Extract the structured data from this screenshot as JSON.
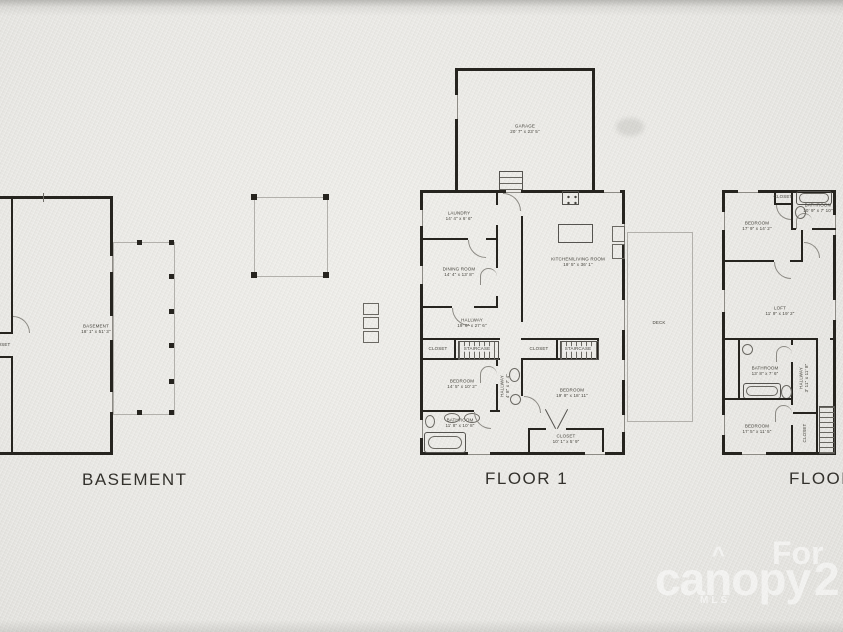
{
  "plans": {
    "basement": {
      "title": "BASEMENT",
      "rooms": {
        "basement": {
          "name": "BASEMENT",
          "dims": "18' 1\" x 51' 3\""
        },
        "closet": {
          "name": "CLOSET"
        }
      }
    },
    "floor1": {
      "title": "FLOOR 1",
      "rooms": {
        "garage": {
          "name": "GARAGE",
          "dims": "20' 7\" x 23' 5\""
        },
        "laundry": {
          "name": "LAUNDRY",
          "dims": "14' 4\" x 6' 6\""
        },
        "dining": {
          "name": "DINING ROOM",
          "dims": "14' 4\" x 13' 8\""
        },
        "kitchen_living": {
          "name": "KITCHEN/LIVING ROOM",
          "dims": "19' 5\" x 36' 1\""
        },
        "hallway": {
          "name": "HALLWAY",
          "dims": "19' 6\" x 27' 6\""
        },
        "closet_left": {
          "name": "CLOSET"
        },
        "stair_left": {
          "name": "STAIRCASE"
        },
        "closet_right": {
          "name": "CLOSET"
        },
        "stair_right": {
          "name": "STAIRCASE"
        },
        "bedroom_left": {
          "name": "BEDROOM",
          "dims": "14' 5\" x 10' 2\""
        },
        "hall_small": {
          "name": "HALLWAY",
          "dims": "4' 8\" x 7' 4\""
        },
        "bedroom_right": {
          "name": "BEDROOM",
          "dims": "19' 9\" x 18' 11\""
        },
        "bathroom": {
          "name": "BATHROOM",
          "dims": "11' 8\" x 10' 8\""
        },
        "closet_bottom": {
          "name": "CLOSET",
          "dims": "10' 1\" x 5' 9\""
        },
        "deck": {
          "name": "DECK"
        }
      }
    },
    "floor2": {
      "title": "FLOOR 2",
      "rooms": {
        "bedroom_top": {
          "name": "BEDROOM",
          "dims": "17' 9\" x 14' 2\""
        },
        "closet_top": {
          "name": "CLOSET"
        },
        "bathroom_top": {
          "name": "BATHROOM",
          "dims": "10' 9\" x 7' 10\""
        },
        "loft": {
          "name": "LOFT",
          "dims": "11' 9\" x 19' 2\""
        },
        "bathroom_mid": {
          "name": "BATHROOM",
          "dims": "13' 8\" x 7' 6\""
        },
        "hallway": {
          "name": "HALLWAY",
          "dims": "3' 11\" x 11' 8\""
        },
        "bedroom_bottom": {
          "name": "BEDROOM",
          "dims": "17' 5\" x 11' 5\""
        },
        "closet_bottom": {
          "name": "CLOSET"
        }
      }
    }
  },
  "watermark": {
    "for_text": "For",
    "brand": "canopy",
    "accent": "^",
    "mls": "MLS",
    "number": "2"
  },
  "colors": {
    "paper": "#eae9e5",
    "wall": "#26241f",
    "watermark": "#ffffff"
  }
}
